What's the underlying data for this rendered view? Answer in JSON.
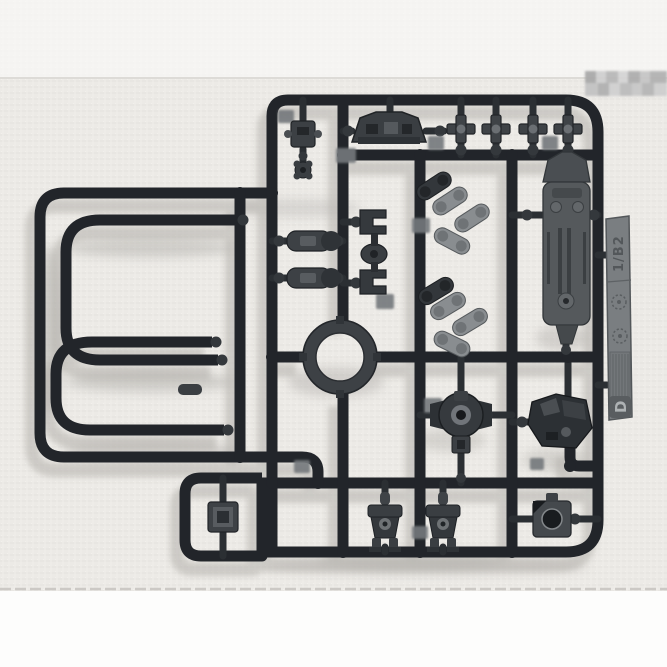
{
  "photo": {
    "scene": "Top-down product photo of an injection-molded plastic model kit runner (sprue) of dark gray parts lying on a white woven fabric background",
    "background_top_band": "bright white margin",
    "background_bottom_band": "bright white margin",
    "watermark": "small pixelated gray blur patch in upper right corner, no legible text"
  },
  "sprue": {
    "plastic_color_name": "dark gunmetal gray",
    "tab_text": "1/B2",
    "tab_letter": "D",
    "tab_symbols": "two molded circular certification marks and a block of fine molded text (illegible)",
    "parts_visible": [
      "two U-shaped pipe/frame rails (left side)",
      "center ring part",
      "four cross-shaped joint polycaps (top row)",
      "vented hull plate (top center)",
      "long flat leg/arm plate with slots (right)",
      "round joint hub with side shoulders (center bottom)",
      "angular foot part (right)",
      "two small torso/waist blocks with legs (bottom)",
      "square socket block with round hole (bottom right)",
      "square box part in small sub-frame (bottom left)",
      "two cylinder segments (mid left)",
      "two C-brackets with oval joint (center left)",
      "cluster of small linkage arms with holes (center)"
    ]
  },
  "colors": {
    "band": "#fafaf9",
    "fabric": "#eceae6",
    "plastic": "#22252a",
    "plastic2": "#2b2f33",
    "plastic-mid": "#3d4145",
    "plastic-light": "#898d90",
    "tab": "#7a7e81",
    "shadow": "#b2b0ab"
  }
}
